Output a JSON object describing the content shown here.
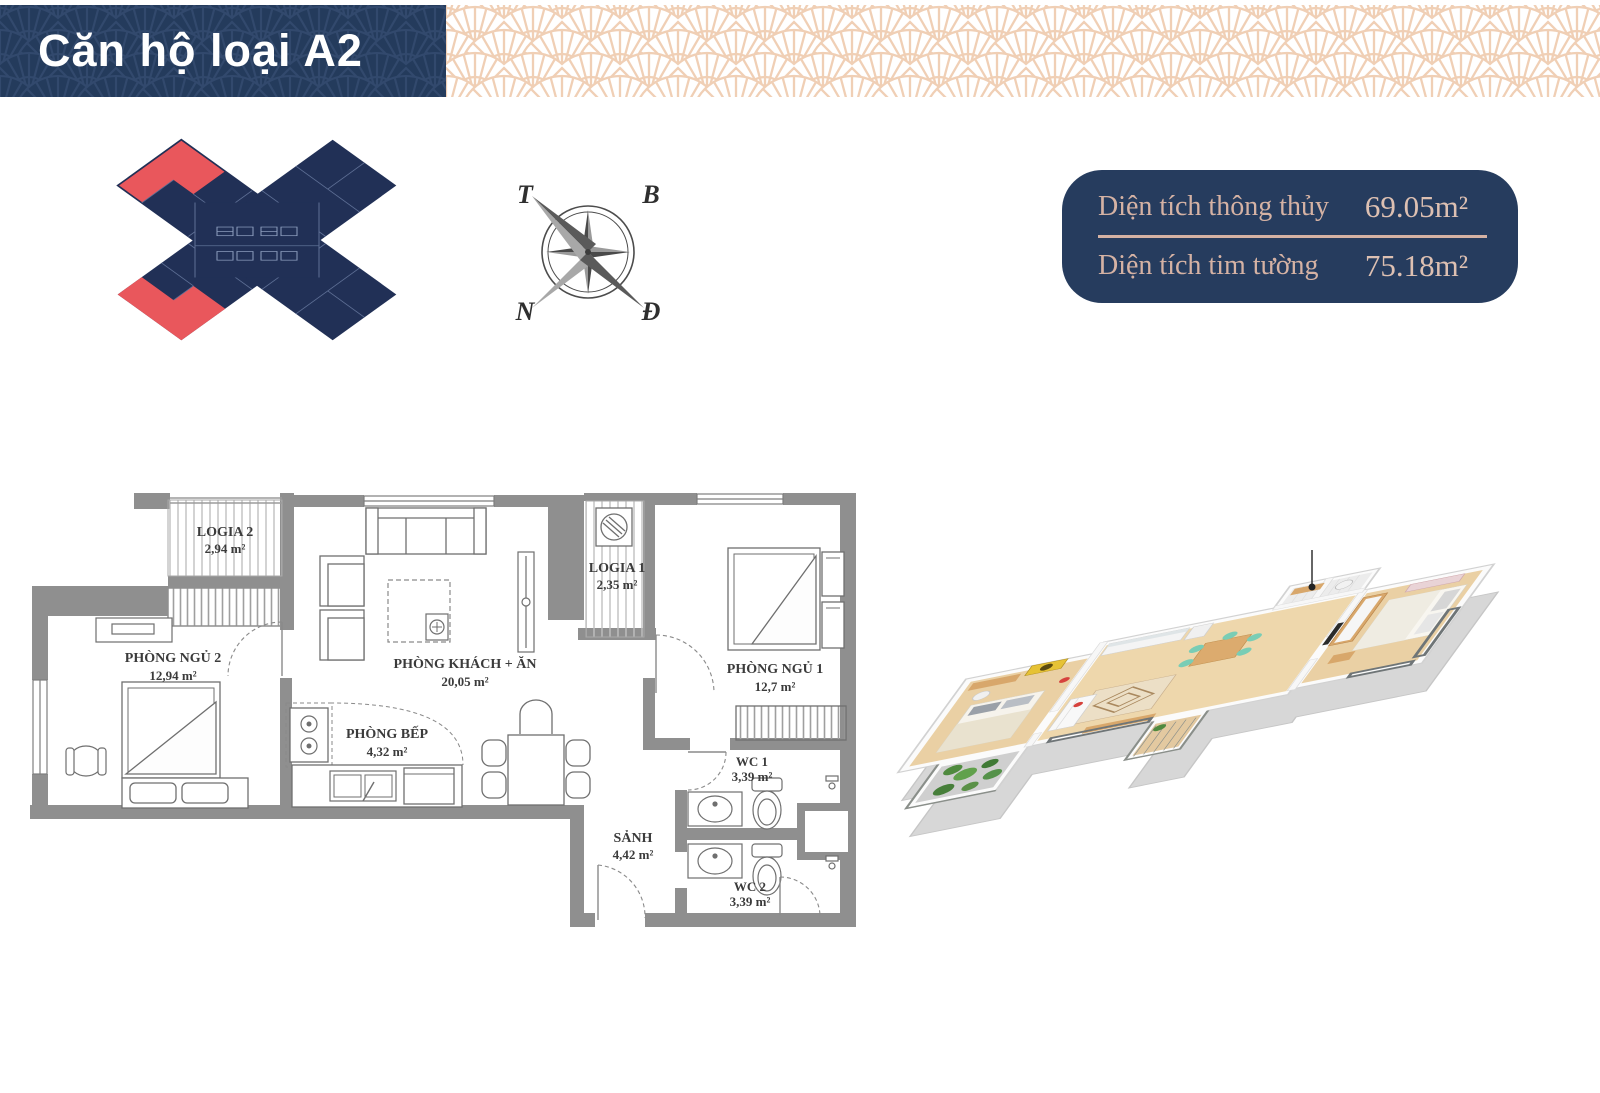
{
  "header": {
    "title": "Căn hộ loại A2",
    "banner_color": "#243b5c",
    "pattern_color": "#f0cfb5"
  },
  "site_plan": {
    "building_color": "#213056",
    "highlight_color": "#e9575c",
    "highlighted_units_count": 2
  },
  "compass": {
    "top_left": "T",
    "top_right": "B",
    "bottom_left": "N",
    "bottom_right": "Đ"
  },
  "area_info": {
    "rows": [
      {
        "label": "Diện tích thông thủy",
        "value": "69.05m²"
      },
      {
        "label": "Diện tích tim tường",
        "value": "75.18m²"
      }
    ],
    "box_color": "#263c5e",
    "text_color": "#d5b2a4"
  },
  "floor_plan": {
    "wall_color": "#8f8f8f",
    "rooms": [
      {
        "name": "LOGIA 2",
        "area": "2,94 m²"
      },
      {
        "name": "PHÒNG NGỦ 2",
        "area": "12,94 m²"
      },
      {
        "name": "PHÒNG KHÁCH + ĂN",
        "area": "20,05 m²"
      },
      {
        "name": "PHÒNG BẾP",
        "area": "4,32 m²"
      },
      {
        "name": "LOGIA 1",
        "area": "2,35 m²"
      },
      {
        "name": "PHÒNG NGỦ 1",
        "area": "12,7 m²"
      },
      {
        "name": "WC 1",
        "area": "3,39 m²"
      },
      {
        "name": "WC 2",
        "area": "3,39 m²"
      },
      {
        "name": "SẢNH",
        "area": "4,42 m²"
      }
    ]
  },
  "render_3d": {
    "floor_color": "#eccfa2",
    "wall_color": "#fbfbfb",
    "accent_wood": "#d8a76b",
    "chair_color": "#79cdb5",
    "plant_color": "#4f8a3e"
  }
}
